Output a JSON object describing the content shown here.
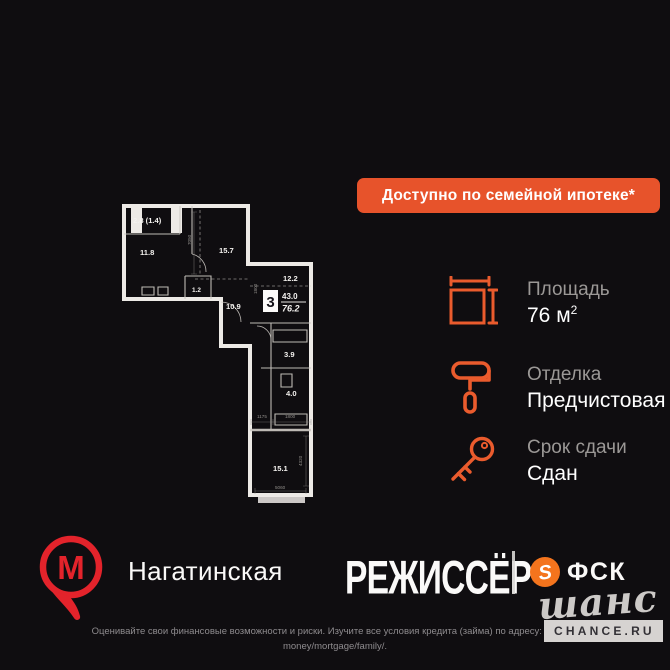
{
  "banner": {
    "label": "Доступно по семейной ипотеке*"
  },
  "floorplan": {
    "rooms_count": "3",
    "area_living": "43.0",
    "area_total": "76.2",
    "rooms": [
      {
        "label": "2.8 (1.4)"
      },
      {
        "label": "11.8"
      },
      {
        "label": "15.7"
      },
      {
        "label": "1.2"
      },
      {
        "label": "10.9"
      },
      {
        "label": "12.2"
      },
      {
        "label": "3.9"
      },
      {
        "label": "4.0"
      },
      {
        "label": "15.1"
      }
    ],
    "dims": [
      "7050",
      "1800",
      "1175",
      "1800",
      "4320",
      "5060"
    ]
  },
  "specs": [
    {
      "label": "Площадь",
      "value": "76 м",
      "sup": "2"
    },
    {
      "label": "Отделка",
      "value": "Предчистовая"
    },
    {
      "label": "Срок сдачи",
      "value": "Сдан"
    }
  ],
  "footer": {
    "metro_letter": "М",
    "station": "Нагатинская",
    "project": "РЕЖИССЁР",
    "developer": "ФСК",
    "watermark_script": "шанс",
    "watermark_badge": "CHANCE.RU"
  },
  "disclaimer": {
    "line1": "Оценивайте свои финансовые возможности и риски. Изучите все условия кредита (займа) по адресу: https://a",
    "line2": "money/mortgage/family/."
  },
  "colors": {
    "background": "#0F0D10",
    "accent_orange": "#E7532B",
    "metro_red": "#E3232B",
    "fsk_orange": "#F4741D"
  }
}
